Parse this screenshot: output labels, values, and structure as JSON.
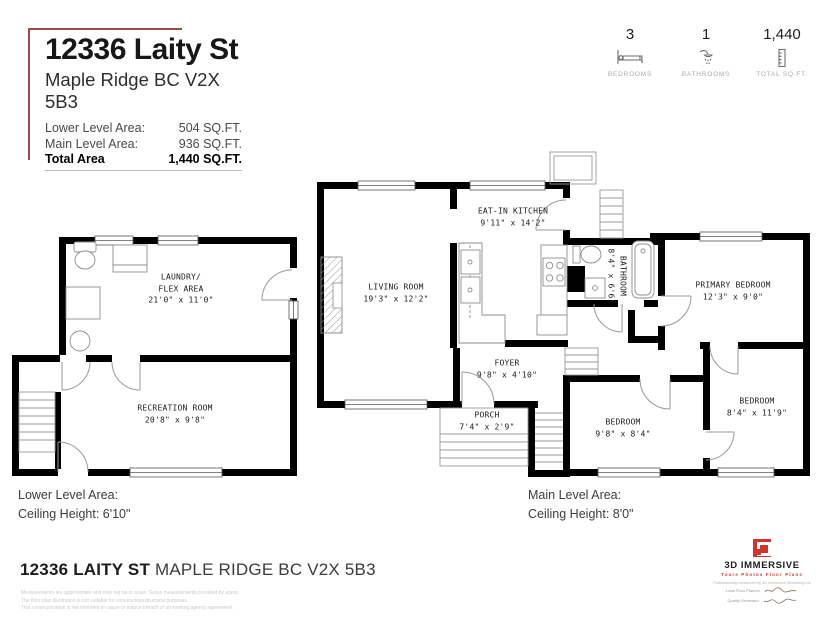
{
  "header": {
    "address": "12336 Laity St",
    "city": "Maple Ridge BC V2X 5B3",
    "areas": [
      {
        "label": "Lower Level Area:",
        "value": "504 SQ.FT."
      },
      {
        "label": "Main Level Area:",
        "value": "936 SQ.FT."
      },
      {
        "label": "Total Area",
        "value": "1,440 SQ.FT."
      }
    ]
  },
  "stats": [
    {
      "value": "3",
      "label": "BEDROOMS",
      "icon": "bed-icon"
    },
    {
      "value": "1",
      "label": "BATHROOMS",
      "icon": "shower-icon"
    },
    {
      "value": "1,440",
      "label": "TOTAL SQ.FT.",
      "icon": "ruler-icon"
    }
  ],
  "lower_level": {
    "rooms": {
      "laundry": {
        "name1": "LAUNDRY/",
        "name2": "FLEX AREA",
        "dims": "21'0\" x 11'0\""
      },
      "recreation": {
        "name": "RECREATION ROOM",
        "dims": "20'8\" x 9'8\""
      }
    },
    "caption": {
      "line1": "Lower Level Area:",
      "line2": "Ceiling Height: 6'10\""
    }
  },
  "main_level": {
    "rooms": {
      "living": {
        "name": "LIVING ROOM",
        "dims": "19'3\" x 12'2\""
      },
      "kitchen": {
        "name": "EAT-IN KITCHEN",
        "dims": "9'11\" x 14'2\""
      },
      "bathroom": {
        "name": "BATHROOM",
        "dims": "8'4\" x 6'6\""
      },
      "primary": {
        "name": "PRIMARY BEDROOM",
        "dims": "12'3\" x 9'0\""
      },
      "bedroom2": {
        "name": "BEDROOM",
        "dims": "9'8\" x 8'4\""
      },
      "bedroom3": {
        "name": "BEDROOM",
        "dims": "8'4\" x 11'9\""
      },
      "foyer": {
        "name": "FOYER",
        "dims": "9'8\" x 4'10\""
      },
      "porch": {
        "name": "PORCH",
        "dims": "7'4\" x 2'9\""
      }
    },
    "caption": {
      "line1": "Main Level Area:",
      "line2": "Ceiling Height: 8'0\""
    }
  },
  "footer": {
    "address_bold": "12336 LAITY ST",
    "address_rest": " MAPLE RIDGE BC V2X 5B3",
    "disclaimers": [
      "Measurements are approximate and may not be to scale. Gross measurements provided by agent.",
      "The floor plan illustration is not suitable for construction/structural purposes.",
      "This communication is not intended to cause or induce breach of an existing agency agreement."
    ],
    "logo": {
      "name": "3D IMMERSIVE",
      "tagline": "Tours  Photos  Floor Plans",
      "measured_by": "Professionally measured by 3D Immersive Marketing Ltd",
      "sig1_label": "Lead Floor Planner",
      "sig2_label": "Quality Reviewed"
    }
  },
  "colors": {
    "accent": "#9c4b4b",
    "wall": "#000000",
    "logo_red": "#d0342c"
  }
}
